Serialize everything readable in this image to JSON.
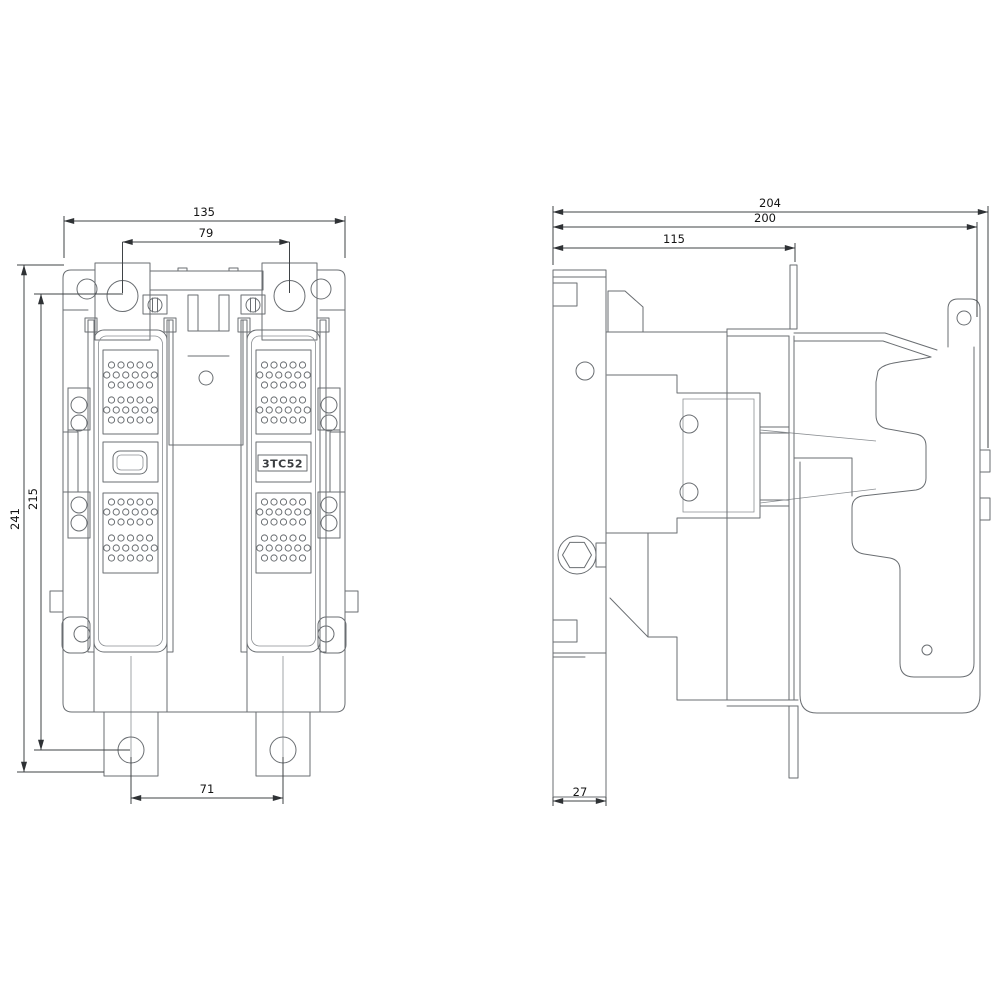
{
  "drawing": {
    "product_label": "3TC52",
    "front_view": {
      "dims": {
        "overall_width": "135",
        "top_hole_spacing": "79",
        "overall_height": "241",
        "mounting_hole_vertical_spacing": "215",
        "bottom_hole_spacing": "71"
      }
    },
    "side_view": {
      "dims": {
        "overall_depth": "204",
        "body_depth": "200",
        "front_section_depth": "115",
        "rail_depth": "27"
      }
    },
    "colors": {
      "background": "#ffffff",
      "geometry_line": "#6a6e72",
      "dimension_line": "#3f4346",
      "text": "#141414"
    }
  }
}
